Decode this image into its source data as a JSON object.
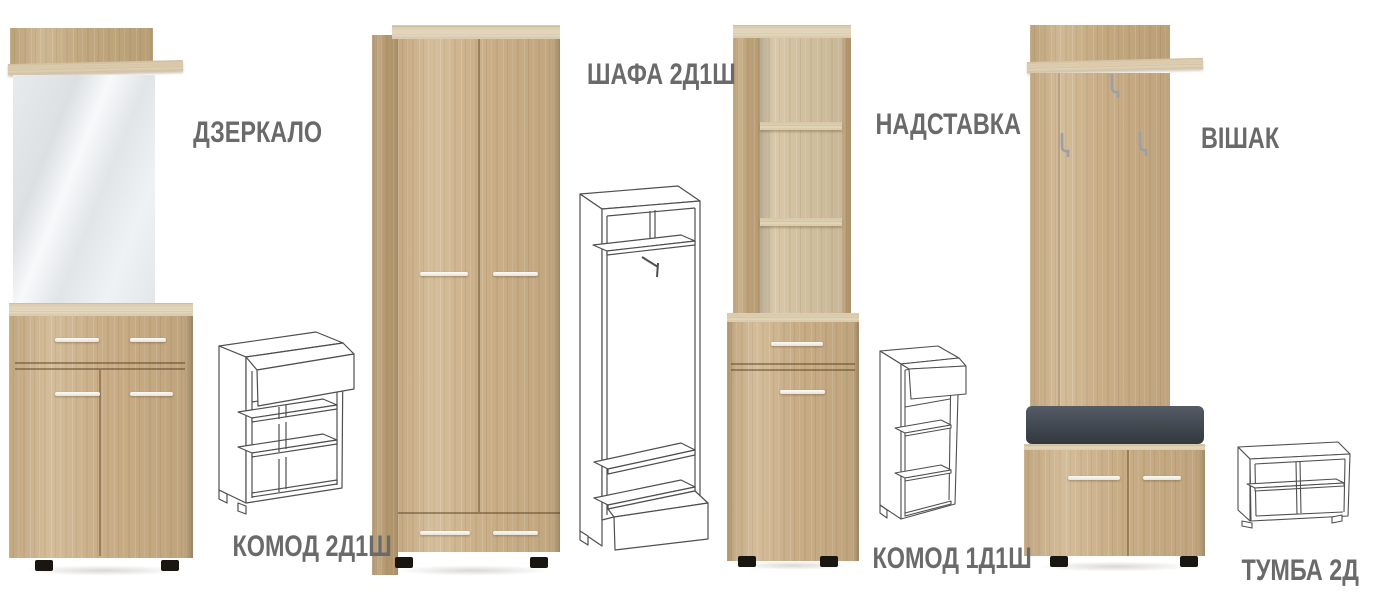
{
  "page": {
    "background": "#ffffff",
    "width": 1375,
    "height": 600
  },
  "palette": {
    "wood": "#cdb28a",
    "wood_side": "#b89c73",
    "wood_top": "#e0d2b4",
    "handle": "#f1efe9",
    "feet": "#191511",
    "cushion_top": "#515761",
    "cushion_bottom": "#33383f",
    "mirror_light": "#f6f8f9",
    "mirror_dark": "#dde1e4",
    "label_text": "#6a6a6a",
    "wireframe_stroke": "#4f4f4f",
    "hook_metal": "#9aa0a4"
  },
  "products": [
    {
      "id": "dzerkalo",
      "label": "ДЗЕРКАЛО",
      "render": "photo"
    },
    {
      "id": "komod-2d1sh",
      "label": "КОМОД 2Д1Ш",
      "render": "line-drawing"
    },
    {
      "id": "shafa-2d1sh",
      "label": "ШАФА 2Д1Ш",
      "render": "photo-and-line-drawing"
    },
    {
      "id": "nadstavka",
      "label": "НАДСТАВКА",
      "render": "photo"
    },
    {
      "id": "komod-1d1sh",
      "label": "КОМОД 1Д1Ш",
      "render": "photo-and-line-drawing"
    },
    {
      "id": "vishak",
      "label": "ВІШАК",
      "render": "photo"
    },
    {
      "id": "tumba-2d",
      "label": "ТУМБА 2Д",
      "render": "line-drawing"
    }
  ]
}
